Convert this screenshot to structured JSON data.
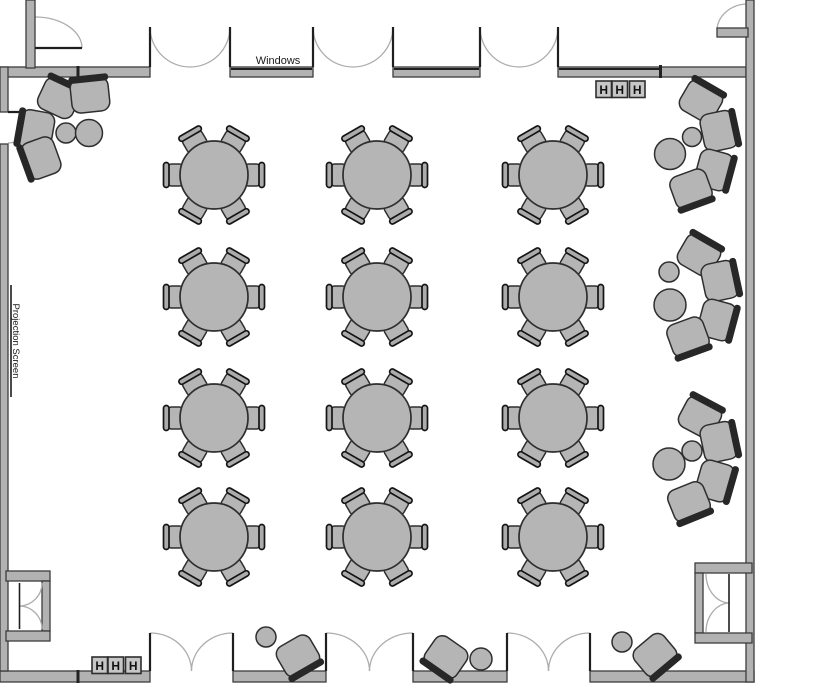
{
  "labels": {
    "windows": "Windows",
    "projection_screen": "Projection Screen",
    "heater_letter": "H"
  },
  "palette": {
    "background": "#ffffff",
    "wall_fill": "#b2b2b2",
    "wall_edge": "#3c3c3c",
    "furniture_fill": "#b5b5b5",
    "furniture_stroke": "#2e2e2e",
    "dining_back_fill": "#ababab",
    "dining_back_stroke": "#141414",
    "lounge_back_fill": "#272727",
    "door_arc": "#adadad",
    "door_leaf": "#1f1f1f",
    "window_line": "#1f1f1f",
    "marker_fill": "#c6c6c6",
    "marker_edge": "#2e2e2e",
    "label_color": "#1a1a1a"
  },
  "floorplan": {
    "canvas": {
      "w": 840,
      "h": 700
    },
    "structure": {
      "top_wall": {
        "y": 67,
        "t": 10,
        "segments": [
          [
            0,
            150
          ],
          [
            230,
            313
          ],
          [
            393,
            480
          ],
          [
            558,
            746
          ]
        ]
      },
      "window_segments": [
        [
          230,
          313
        ],
        [
          393,
          480
        ],
        [
          558,
          661
        ]
      ],
      "bottom_wall": {
        "y": 671,
        "t": 11,
        "segments": [
          [
            0,
            150
          ],
          [
            233,
            326
          ],
          [
            413,
            507
          ],
          [
            590,
            754
          ]
        ]
      },
      "left_wall": {
        "x": 0,
        "t": 8,
        "segments": [
          [
            67,
            112
          ],
          [
            144,
            671
          ]
        ]
      },
      "right_wall": {
        "x": 746,
        "t": 8,
        "segments": [
          [
            0,
            682
          ]
        ]
      },
      "corner_bar_topleft": [
        26,
        0,
        9,
        68
      ],
      "top_doors": [
        {
          "x1": 150,
          "x2": 230
        },
        {
          "x1": 313,
          "x2": 393
        },
        {
          "x1": 480,
          "x2": 558
        }
      ],
      "bottom_doors": [
        {
          "x1": 150,
          "x2": 233
        },
        {
          "x1": 326,
          "x2": 413
        },
        {
          "x1": 507,
          "x2": 590
        }
      ],
      "left_door": {
        "y1": 112,
        "y2": 144
      },
      "corner_door_topleft": {
        "leaf": [
          35,
          48,
          82,
          48
        ],
        "arc": "M 82,48 A 47,31 0 0 0 35,17"
      },
      "corner_door_topright": {
        "leaf_rect": [
          717,
          28,
          31,
          9
        ],
        "arc": "M 717,30 A 31,27 0 0 1 746,4"
      },
      "vestibule_left": {
        "bars": [
          [
            6,
            571,
            44,
            10
          ],
          [
            42,
            581,
            8,
            50
          ],
          [
            6,
            631,
            44,
            10
          ]
        ],
        "arcs": [
          "M 42,583 A 23,23 0 0 1 19.5,606",
          "M 42,629 A 23,23 0 0 0 19.5,606"
        ],
        "leaf": [
          19.5,
          583,
          19.5,
          629
        ]
      },
      "vestibule_right": {
        "bars": [
          [
            695,
            563,
            57,
            10
          ],
          [
            695,
            573,
            8,
            60
          ],
          [
            695,
            633,
            57,
            10
          ]
        ],
        "arcs": [
          "M 706,574 A 24,29 0 0 0 729,603",
          "M 706,632 A 24,29 0 0 1 729,603"
        ],
        "leaf": [
          729,
          574,
          729,
          632
        ]
      },
      "joint_ticks": [
        [
          76.5,
          66,
          3,
          12
        ],
        [
          659,
          65,
          3,
          13
        ],
        [
          76.5,
          670,
          3,
          13
        ]
      ],
      "projection_screen_line": {
        "x": 11,
        "y1": 285,
        "y2": 397
      }
    },
    "banquet_tables": {
      "columns_x": [
        214,
        377,
        553
      ],
      "rows_y": [
        175,
        297,
        418,
        537
      ],
      "table_radius": 34,
      "chairs_per_table": 6,
      "chair_angles_deg": [
        0,
        60,
        120,
        180,
        240,
        300
      ],
      "chair_distance": 38.5
    },
    "lounge_clusters": [
      {
        "name": "corner-top-left",
        "chairs": [
          [
            59,
            98,
            25
          ],
          [
            90,
            95,
            -6
          ],
          [
            36,
            130,
            -80
          ],
          [
            41,
            158,
            -110
          ]
        ],
        "tables": [
          [
            66,
            133,
            10
          ],
          [
            89,
            133,
            13.5
          ]
        ]
      },
      {
        "name": "right-upper",
        "chairs": [
          [
            701,
            101,
            30
          ],
          [
            719,
            131,
            78
          ],
          [
            714,
            170,
            105
          ],
          [
            691,
            189,
            160
          ]
        ],
        "tables": [
          [
            692,
            137,
            9.5
          ],
          [
            670,
            154,
            15.5
          ]
        ]
      },
      {
        "name": "right-middle",
        "chairs": [
          [
            699,
            255,
            30
          ],
          [
            720,
            281,
            78
          ],
          [
            717,
            320,
            105
          ],
          [
            688,
            337,
            160
          ]
        ],
        "tables": [
          [
            669,
            272,
            10
          ],
          [
            670,
            305,
            16
          ]
        ]
      },
      {
        "name": "right-lower",
        "chairs": [
          [
            700,
            417,
            28
          ],
          [
            719,
            442,
            78
          ],
          [
            715,
            481,
            106
          ],
          [
            689,
            502,
            158
          ]
        ],
        "tables": [
          [
            692,
            451,
            10
          ],
          [
            669,
            464,
            16
          ]
        ]
      }
    ],
    "side_seats": [
      {
        "name": "bottom-left-pair",
        "table": [
          266,
          637,
          10
        ],
        "chair": [
          298,
          656,
          150
        ]
      },
      {
        "name": "bottom-center-pair",
        "table": [
          481,
          659,
          11
        ],
        "chair": [
          446,
          657,
          215
        ]
      },
      {
        "name": "bottom-right-pair",
        "table": [
          622,
          642,
          10
        ],
        "chair": [
          655,
          655,
          140
        ]
      }
    ],
    "heater_markers": [
      {
        "x": 596,
        "y": 81,
        "box_offsets": [
          0,
          16,
          33.5
        ],
        "box_w": 15.5,
        "box_h": 16.5
      },
      {
        "x": 92,
        "y": 657,
        "box_offsets": [
          0,
          16,
          33.5
        ],
        "box_w": 15.5,
        "box_h": 16.5
      }
    ],
    "label_positions": {
      "windows": {
        "x": 278,
        "y": 64,
        "size": 11
      },
      "projection_screen": {
        "x": 13,
        "y": 341,
        "size": 9.5,
        "rotate": 90
      }
    }
  }
}
